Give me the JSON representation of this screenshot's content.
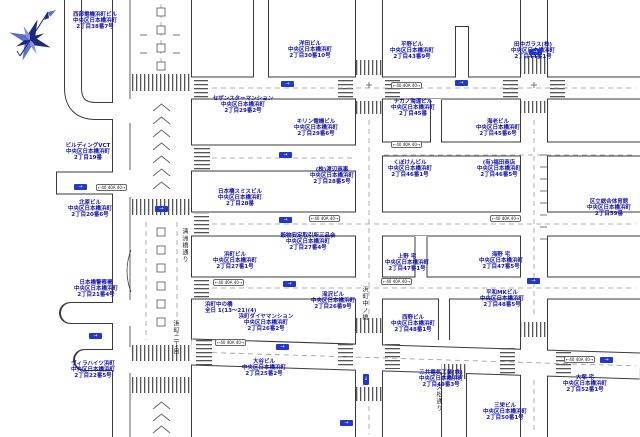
{
  "map": {
    "area_name": "中央区日本橋浜町",
    "oneway_arrow_h": "→",
    "oneway_arrow_v": "↓",
    "road_marker_text": "←40 40A 40→",
    "street_names": [
      {
        "text": "清洲橋通り"
      },
      {
        "text": "浜町二丁目"
      },
      {
        "text": "浜町中ノ橋"
      },
      {
        "text": "久松通り"
      }
    ],
    "note": {
      "line1": "浜町中の橋",
      "line2": "全日 1(13〜21)(4)"
    },
    "buildings": [
      {
        "name": "西部電機浜町ビル",
        "address": "中央区日本橋浜町",
        "block": "2丁目38番7号"
      },
      {
        "name": "ビルディングVCT",
        "address": "中央区日本橋浜町",
        "block": "2丁目19番"
      },
      {
        "name": "北原ビル",
        "address": "中央区日本橋浜町",
        "block": "2丁目20番6号"
      },
      {
        "name": "日本橋警察署",
        "address": "中央区日本橋浜町",
        "block": "2丁目21番4号"
      },
      {
        "name": "ヴィラハイツ浜町",
        "address": "中央区日本橋浜町",
        "block": "2丁目22番5号"
      },
      {
        "name": "セザンスターマンション",
        "address": "中央区日本橋浜町",
        "block": "2丁目29番2号"
      },
      {
        "name": "キリン電機ビル",
        "address": "中央区日本橋浜町",
        "block": "2丁目29番6号"
      },
      {
        "name": "洋田ビル",
        "address": "中央区日本橋浜町",
        "block": "2丁目30番10号"
      },
      {
        "name": "平野ビル",
        "address": "中央区日本橋浜町",
        "block": "2丁目43番9号"
      },
      {
        "name": "田中ガラス(株)",
        "address": "中央区日本橋浜町",
        "block": "2丁目44番1号"
      },
      {
        "name": "ナカノ海運ビル",
        "address": "中央区日本橋浜町",
        "block": "2丁目45番"
      },
      {
        "name": "海老ビル",
        "address": "中央区日本橋浜町",
        "block": "2丁目45番6号"
      },
      {
        "name": "くぼけんビル",
        "address": "中央区日本橋浜町",
        "block": "2丁目46番1号"
      },
      {
        "name": "(有)福田商店",
        "address": "中央区日本橋浜町",
        "block": "2丁目46番5号"
      },
      {
        "name": "日本橋スミスビル",
        "address": "中央区日本橋浜町",
        "block": "2丁目28番"
      },
      {
        "name": "(株)渡辺商事",
        "address": "中央区日本橋浜町",
        "block": "2丁目28番5号"
      },
      {
        "name": "穀物安定取引所三品会",
        "address": "中央区日本橋浜町",
        "block": "2丁目27番4号"
      },
      {
        "name": "浜町ビル",
        "address": "中央区日本橋浜町",
        "block": "2丁目27番1号"
      },
      {
        "name": "上野 宅",
        "address": "中央区日本橋浜町",
        "block": "2丁目47番1号"
      },
      {
        "name": "海野 宅",
        "address": "中央区日本橋浜町",
        "block": "2丁目47番5号"
      },
      {
        "name": "滝沢ビル",
        "address": "中央区日本橋浜町",
        "block": "2丁目26番9号"
      },
      {
        "name": "浜町ダイヤマンション",
        "address": "中央区日本橋浜町",
        "block": "2丁目26番2号"
      },
      {
        "name": "西野ビル",
        "address": "中央区日本橋浜町",
        "block": "2丁目48番1号"
      },
      {
        "name": "平和MKビル",
        "address": "中央区日本橋浜町",
        "block": "2丁目48番5号"
      },
      {
        "name": "大谷ビル",
        "address": "中央区日本橋浜町",
        "block": "2丁目25番2号"
      },
      {
        "name": "三共電気工業(株)",
        "address": "中央区日本橋浜町",
        "block": "2丁目49番3号"
      },
      {
        "name": "大塚 宅",
        "address": "中央区日本橋浜町",
        "block": "2丁目52番1号"
      },
      {
        "name": "三栄ビル",
        "address": "中央区日本橋浜町",
        "block": "2丁目50番1号"
      },
      {
        "name": "区立総合体育館",
        "address": "中央区日本橋浜町",
        "block": "2丁目59番"
      }
    ]
  }
}
